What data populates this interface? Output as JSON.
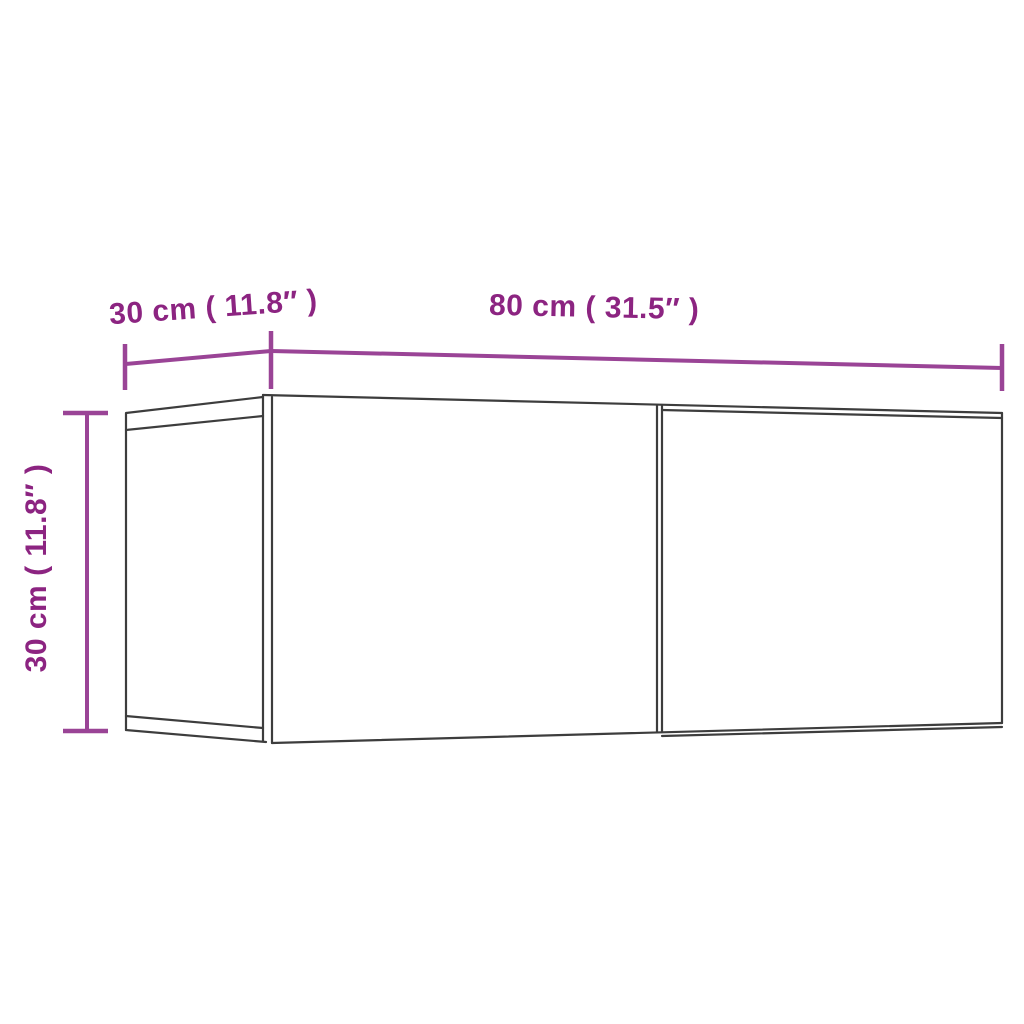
{
  "diagram": {
    "title": "TV wall cabinet dimension drawing",
    "labels": {
      "depth": "30 cm ( 11.8″ )",
      "width": "80 cm ( 31.5″ )",
      "height": "30 cm ( 11.8″ )"
    }
  },
  "colors": {
    "label_text": "#8c2481",
    "dimension_line": "#9a4496",
    "outline": "#3d3d3d",
    "background": "#ffffff"
  }
}
